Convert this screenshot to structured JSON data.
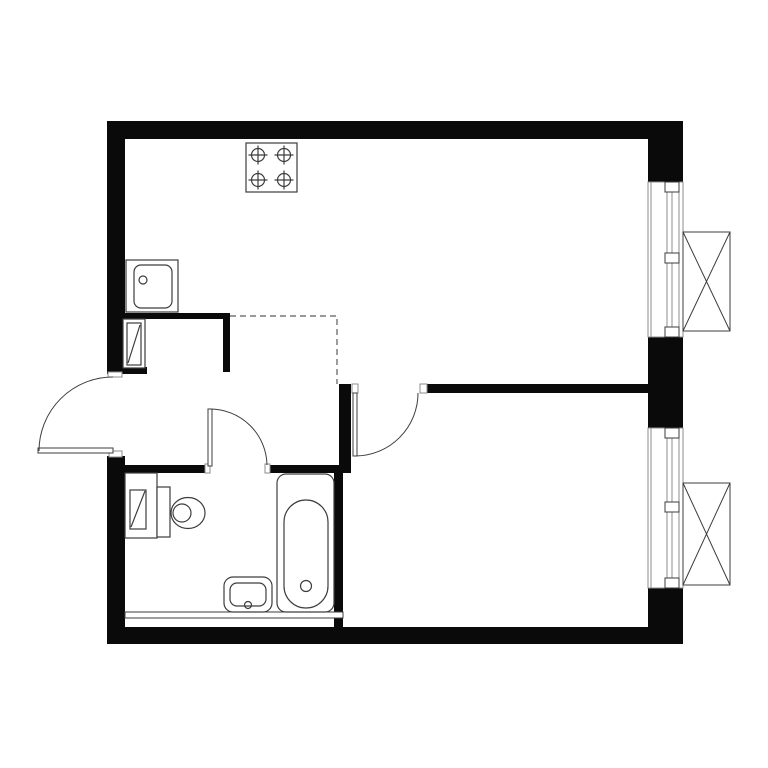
{
  "plan": {
    "canvas": {
      "width": 768,
      "height": 768,
      "background": "#ffffff"
    },
    "colors": {
      "wall": "#0a0a0a",
      "fixture_line": "#3d3d3d",
      "light_line": "#8c8c8c",
      "dashed_line": "#5a5a5a",
      "white": "#ffffff"
    },
    "walls": [
      {
        "name": "top-exterior-wall",
        "x": 107,
        "y": 121,
        "w": 576,
        "h": 18
      },
      {
        "name": "left-exterior-wall-upper",
        "x": 107,
        "y": 121,
        "w": 18,
        "h": 253
      },
      {
        "name": "left-exterior-wall-lower",
        "x": 107,
        "y": 456,
        "w": 18,
        "h": 187
      },
      {
        "name": "bottom-exterior-wall",
        "x": 107,
        "y": 627,
        "w": 576,
        "h": 17
      },
      {
        "name": "right-exterior-wall-top",
        "x": 648,
        "y": 121,
        "w": 35,
        "h": 61
      },
      {
        "name": "right-exterior-wall-mid",
        "x": 648,
        "y": 337,
        "w": 35,
        "h": 91
      },
      {
        "name": "right-exterior-wall-bottom",
        "x": 648,
        "y": 588,
        "w": 35,
        "h": 56
      },
      {
        "name": "entry-pier-stub",
        "x": 125,
        "y": 367,
        "w": 22,
        "h": 7
      },
      {
        "name": "kitchen-hall-wall",
        "x": 107,
        "y": 313,
        "w": 123,
        "h": 6
      },
      {
        "name": "hall-stub-wall",
        "x": 223,
        "y": 318,
        "w": 7,
        "h": 54
      },
      {
        "name": "living-bedroom-wall",
        "x": 427,
        "y": 384,
        "w": 221,
        "h": 9
      },
      {
        "name": "hall-bedroom-divider",
        "x": 339,
        "y": 384,
        "w": 12,
        "h": 89
      },
      {
        "name": "bathroom-top-wall-left",
        "x": 125,
        "y": 465,
        "w": 80,
        "h": 8
      },
      {
        "name": "bathroom-top-wall-right",
        "x": 270,
        "y": 465,
        "w": 70,
        "h": 8
      },
      {
        "name": "bathroom-right-wall",
        "x": 334,
        "y": 465,
        "w": 9,
        "h": 162
      }
    ],
    "partitions": [
      {
        "name": "bathroom-bottom-partition",
        "x": 125,
        "y": 612,
        "w": 218,
        "h": 6
      }
    ],
    "jambs": [
      {
        "name": "entrance-door-jamb-top",
        "x": 108,
        "y": 372,
        "w": 14,
        "h": 5
      },
      {
        "name": "entrance-door-jamb-bottom",
        "x": 109,
        "y": 451,
        "w": 13,
        "h": 6
      },
      {
        "name": "bathroom-door-jamb-left",
        "x": 205,
        "y": 464,
        "w": 5,
        "h": 9
      },
      {
        "name": "bathroom-door-jamb-right",
        "x": 265,
        "y": 464,
        "w": 5,
        "h": 9
      },
      {
        "name": "bedroom-door-jamb-left",
        "x": 352,
        "y": 384,
        "w": 6,
        "h": 9
      },
      {
        "name": "bedroom-door-jamb-right",
        "x": 420,
        "y": 384,
        "w": 7,
        "h": 9
      }
    ],
    "doors": [
      {
        "name": "entrance-door",
        "leaf": {
          "x": 38,
          "y": 448,
          "w": 75,
          "h": 5
        },
        "arc": "M 113 377 A 74 74 0 0 0 39 451"
      },
      {
        "name": "bathroom-door",
        "leaf": {
          "x": 208,
          "y": 409,
          "w": 4,
          "h": 57
        },
        "arc": "M 210 409 A 57 57 0 0 1 267 465"
      },
      {
        "name": "bedroom-door",
        "leaf": {
          "x": 353,
          "y": 393,
          "w": 4,
          "h": 63
        },
        "arc": "M 355 456 A 63 63 0 0 0 418 393"
      }
    ],
    "windows": [
      {
        "name": "living-room-window",
        "x": 648,
        "y": 182,
        "w": 35,
        "h": 155,
        "sill_x": 651,
        "frame_x1": 667,
        "frame_x2": 672,
        "outer_x": 679,
        "mullion_x": 665,
        "mullion_w": 14,
        "mullion_h": 10,
        "mullions_y": [
          182,
          253,
          327
        ]
      },
      {
        "name": "bedroom-window",
        "x": 648,
        "y": 428,
        "w": 35,
        "h": 160,
        "sill_x": 651,
        "frame_x1": 667,
        "frame_x2": 672,
        "outer_x": 679,
        "mullion_x": 665,
        "mullion_w": 14,
        "mullion_h": 10,
        "mullions_y": [
          428,
          502,
          578
        ]
      }
    ],
    "baskets": [
      {
        "name": "ac-basket-upper",
        "x": 683,
        "y": 232,
        "w": 47,
        "h": 99
      },
      {
        "name": "ac-basket-lower",
        "x": 683,
        "y": 483,
        "w": 47,
        "h": 102
      }
    ],
    "kitchen_boundary": {
      "name": "kitchen-zone-dashed-boundary",
      "points": [
        [
          230,
          316
        ],
        [
          337,
          316
        ],
        [
          337,
          384
        ]
      ]
    },
    "fixtures": [
      {
        "name": "kitchen-stove",
        "shapes": [
          {
            "t": "rect",
            "x": 246,
            "y": 143,
            "w": 51,
            "h": 49,
            "f": "#ffffff"
          },
          {
            "t": "circle",
            "cx": 258,
            "cy": 155,
            "r": 6.5
          },
          {
            "t": "line",
            "x1": 258,
            "y1": 145.5,
            "x2": 258,
            "y2": 164.5
          },
          {
            "t": "line",
            "x1": 248.5,
            "y1": 155,
            "x2": 267.5,
            "y2": 155
          },
          {
            "t": "circle",
            "cx": 284,
            "cy": 155,
            "r": 6.5
          },
          {
            "t": "line",
            "x1": 284,
            "y1": 145.5,
            "x2": 284,
            "y2": 164.5
          },
          {
            "t": "line",
            "x1": 274.5,
            "y1": 155,
            "x2": 293.5,
            "y2": 155
          },
          {
            "t": "circle",
            "cx": 258,
            "cy": 180,
            "r": 6.5
          },
          {
            "t": "line",
            "x1": 258,
            "y1": 170.5,
            "x2": 258,
            "y2": 189.5
          },
          {
            "t": "line",
            "x1": 248.5,
            "y1": 180,
            "x2": 267.5,
            "y2": 180
          },
          {
            "t": "circle",
            "cx": 284,
            "cy": 180,
            "r": 6.5
          },
          {
            "t": "line",
            "x1": 284,
            "y1": 170.5,
            "x2": 284,
            "y2": 189.5
          },
          {
            "t": "line",
            "x1": 274.5,
            "y1": 180,
            "x2": 293.5,
            "y2": 180
          }
        ]
      },
      {
        "name": "kitchen-sink",
        "shapes": [
          {
            "t": "rect",
            "x": 126,
            "y": 260,
            "w": 52,
            "h": 52,
            "f": "#ffffff"
          },
          {
            "t": "rect",
            "x": 134,
            "y": 265,
            "w": 38,
            "h": 43,
            "rx": 7
          },
          {
            "t": "circle",
            "cx": 143,
            "cy": 280,
            "r": 4
          }
        ]
      },
      {
        "name": "hall-utility-cabinet",
        "shapes": [
          {
            "t": "rect",
            "x": 123,
            "y": 319,
            "w": 22,
            "h": 49,
            "f": "#ffffff"
          },
          {
            "t": "rect",
            "x": 127,
            "y": 323,
            "w": 14,
            "h": 42
          },
          {
            "t": "line",
            "x1": 128,
            "y1": 363,
            "x2": 140,
            "y2": 325
          }
        ]
      },
      {
        "name": "bathroom-utility-shaft",
        "shapes": [
          {
            "t": "rect",
            "x": 125,
            "y": 473,
            "w": 32,
            "h": 65,
            "f": "#ffffff"
          },
          {
            "t": "rect",
            "x": 130,
            "y": 490,
            "w": 16,
            "h": 39
          },
          {
            "t": "line",
            "x1": 131,
            "y1": 527,
            "x2": 145,
            "y2": 491
          }
        ]
      },
      {
        "name": "toilet",
        "shapes": [
          {
            "t": "rect",
            "x": 157,
            "y": 487,
            "w": 13,
            "h": 50,
            "f": "#ffffff"
          },
          {
            "t": "ellipse",
            "cx": 188,
            "cy": 513,
            "rx": 17,
            "ry": 15.5,
            "f": "#ffffff"
          },
          {
            "t": "ellipse",
            "cx": 182,
            "cy": 513,
            "rx": 9,
            "ry": 9
          }
        ]
      },
      {
        "name": "washbasin",
        "shapes": [
          {
            "t": "rect",
            "x": 224,
            "y": 577,
            "w": 48,
            "h": 35,
            "rx": 9,
            "f": "#ffffff"
          },
          {
            "t": "rect",
            "x": 230,
            "y": 583,
            "w": 36,
            "h": 23,
            "rx": 7
          },
          {
            "t": "circle",
            "cx": 248,
            "cy": 605,
            "r": 3.5
          }
        ]
      },
      {
        "name": "bathtub",
        "shapes": [
          {
            "t": "rect",
            "x": 277,
            "y": 474,
            "w": 57,
            "h": 138,
            "rx": 9,
            "f": "#ffffff"
          },
          {
            "t": "rect",
            "x": 284,
            "y": 500,
            "w": 44,
            "h": 108,
            "rx": 22
          },
          {
            "t": "circle",
            "cx": 306,
            "cy": 586,
            "r": 5.5
          }
        ]
      }
    ]
  }
}
